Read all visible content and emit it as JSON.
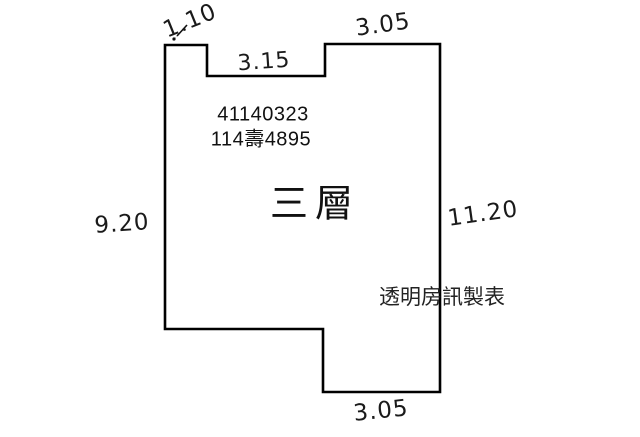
{
  "diagram": {
    "type": "floor-plan",
    "floor_label": "三層",
    "case_number_line1": "41140323",
    "case_number_line2": "114壽4895",
    "credit": "透明房訊製表",
    "dimensions": {
      "top_left": "1.10",
      "inner_top": "3.15",
      "top_right": "3.05",
      "left": "9.20",
      "right": "11.20",
      "bottom": "3.05"
    },
    "colors": {
      "background": "#ffffff",
      "line": "#000000",
      "text": "#111111"
    }
  }
}
